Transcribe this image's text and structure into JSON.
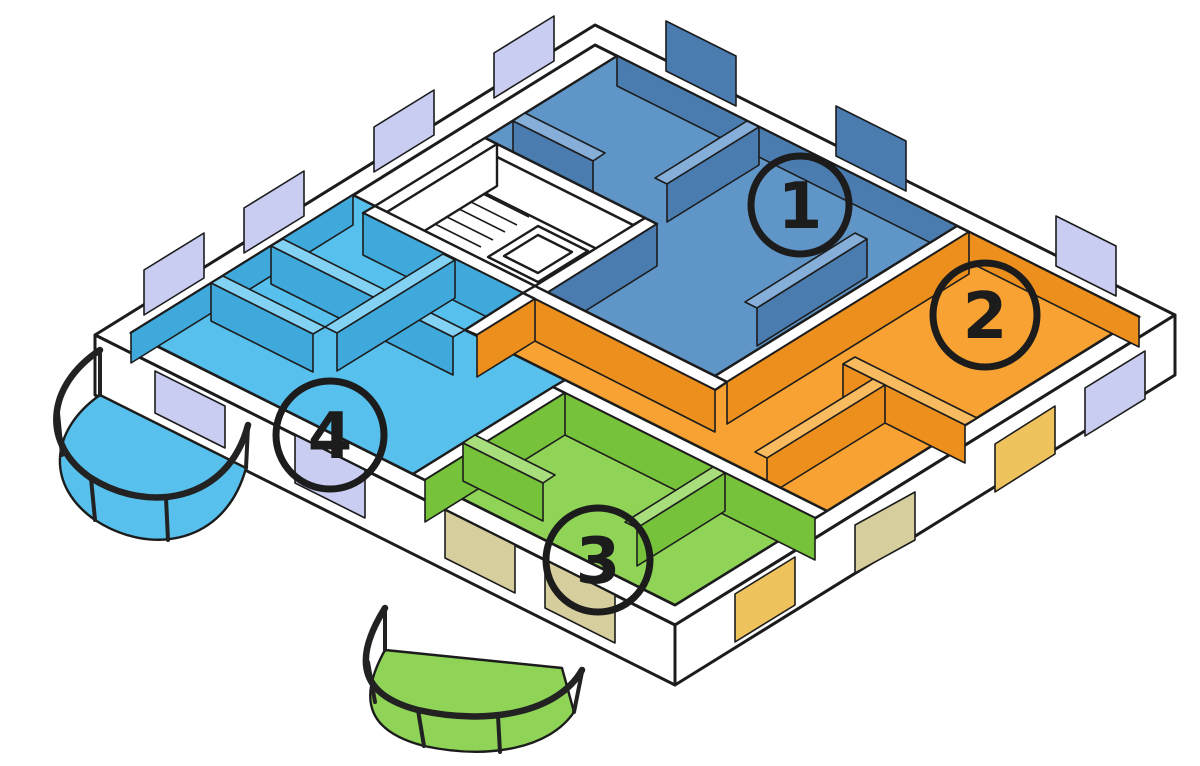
{
  "diagram": {
    "type": "isometric-floor-plan",
    "description": "Cut-away axonometric floor plan of one apartment-building storey with four colour-coded dwelling units numbered 1 to 4",
    "units": [
      {
        "label": "1",
        "name": "unit-1",
        "floor": "#6095c7",
        "wall": "#4a7cb0",
        "top": "#85aed8"
      },
      {
        "label": "2",
        "name": "unit-2",
        "floor": "#f7a233",
        "wall": "#ec8f1d",
        "top": "#f9bb60"
      },
      {
        "label": "3",
        "name": "unit-3",
        "floor": "#8fd457",
        "wall": "#76c23b",
        "top": "#a9de7c"
      },
      {
        "label": "4",
        "name": "unit-4",
        "floor": "#57c0ed",
        "wall": "#3fa9dc",
        "top": "#84d2f3"
      }
    ],
    "palette": {
      "outline": "#1c1c1c",
      "wall_white": "#ffffff",
      "glass_cool": "#c9cdf2",
      "glass_warm": "#eec35e",
      "glass_khaki": "#d6cf9d",
      "glass_blue": "#4a7cb0",
      "railing": "#222222",
      "background": "#ffffff"
    },
    "features": {
      "staircase": "staircase",
      "elevator": "elevator-shaft",
      "balcony_left": "unit-4-balcony",
      "balcony_bottom": "unit-3-balcony"
    }
  }
}
